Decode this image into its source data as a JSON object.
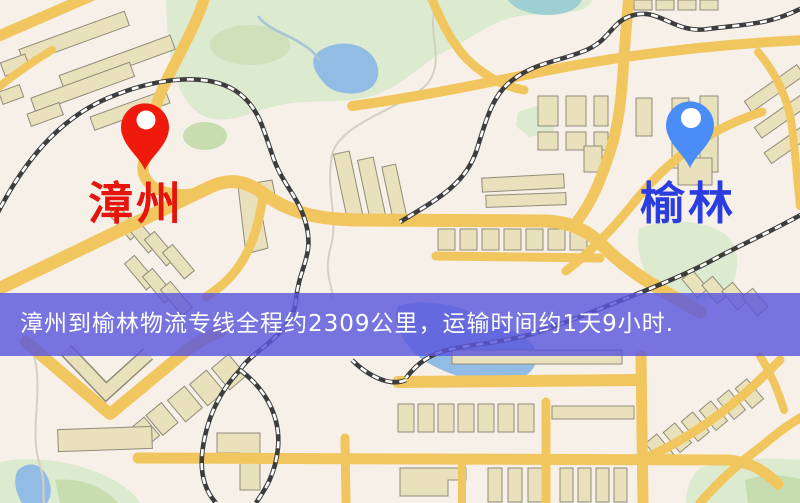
{
  "banner": {
    "text": "漳州到榆林物流专线全程约2309公里，运输时间约1天9小时.",
    "origin": "漳州",
    "destination": "榆林",
    "distance": "约2309公里",
    "duration": "约1天9小时"
  },
  "markers": [
    {
      "label": "漳州",
      "pin": "red-map-pin",
      "pin_color": "#ef1a0c",
      "label_color": "#e3150c"
    },
    {
      "label": "榆林",
      "pin": "blue-map-pin",
      "pin_color": "#4b8df7",
      "label_color": "#2a3ee0"
    }
  ],
  "colors": {
    "map-bg": "#f7f0e9",
    "road": "#f2c65e",
    "park": "#dcead0",
    "park-dark": "#c7ddb0",
    "water": "#93bce4",
    "building-fill": "#e9e0bc",
    "building-stroke": "#8f8c79",
    "rail-dark": "#3d3d3d",
    "rail-light": "#ffffff",
    "footpath": "#d5cfc3",
    "banner-bg": "#5a57dd",
    "banner-text": "#ffffff",
    "pin-red": "#ef1a0c",
    "pin-blue": "#4b8df7",
    "label-red": "#e3150c",
    "label-blue": "#2a3ee0"
  }
}
